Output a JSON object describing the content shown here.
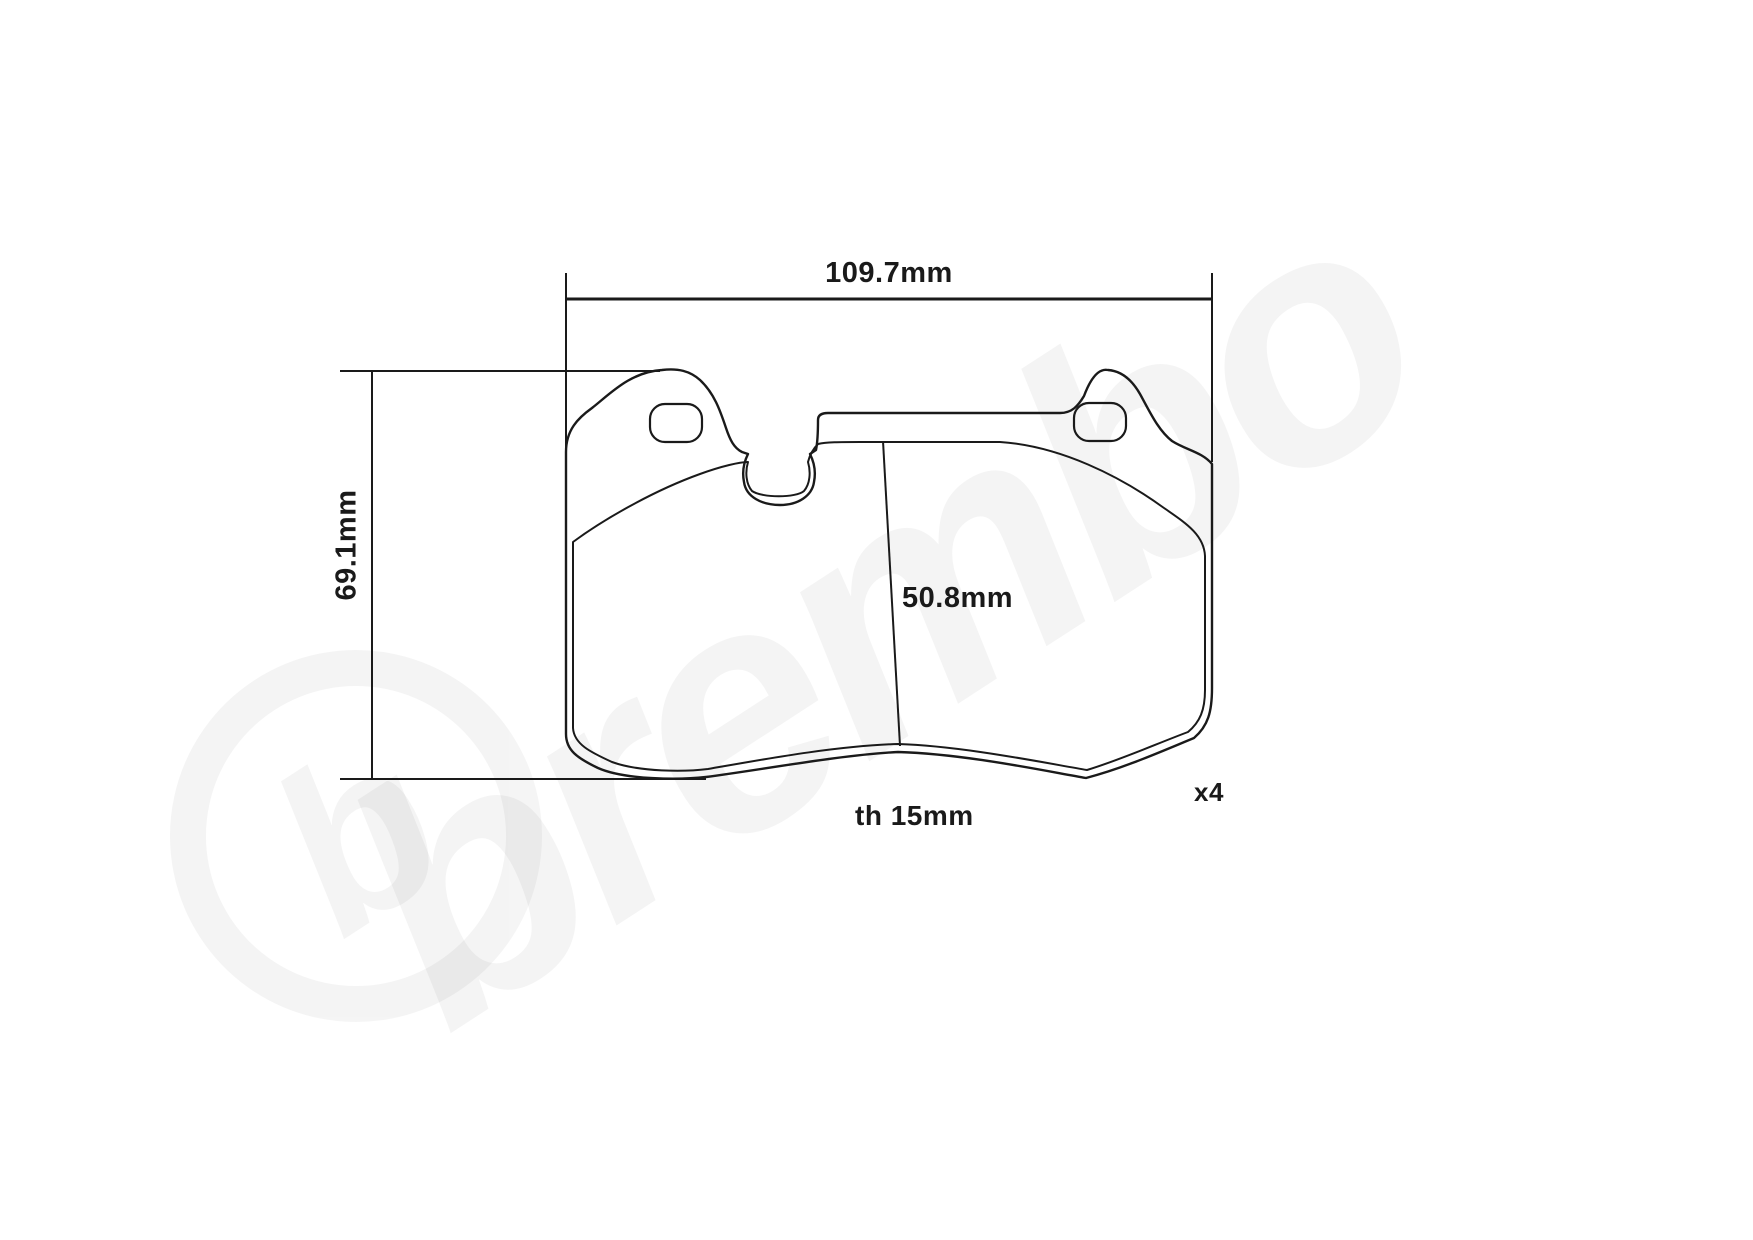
{
  "diagram": {
    "type": "brake-pad-technical-drawing",
    "dimensions": {
      "width_label": "109.7mm",
      "height_label": "69.1mm",
      "pad_height_label": "50.8mm",
      "thickness_label": "th 15mm",
      "quantity_label": "x4"
    },
    "watermark": {
      "brand": "brembo",
      "logo_letter": "b"
    },
    "colors": {
      "line": "#1a1a1a",
      "background": "#ffffff"
    }
  }
}
